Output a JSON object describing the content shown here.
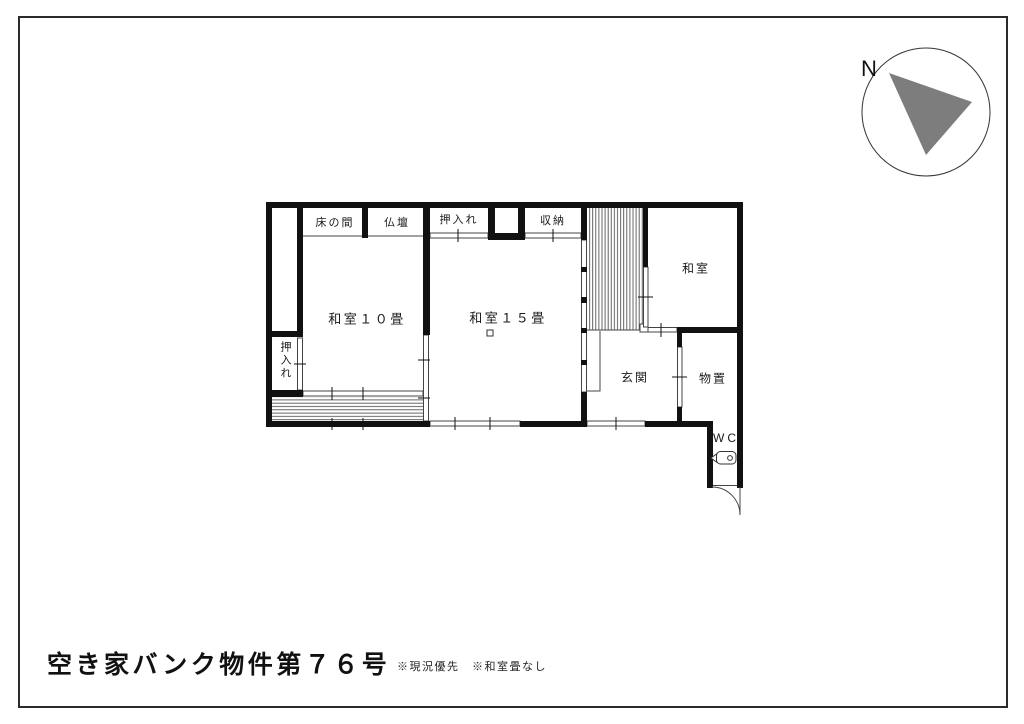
{
  "page": {
    "background": "#ffffff",
    "border_color": "#2b2b2b"
  },
  "title_block": {
    "title": "空き家バンク物件第７６号",
    "note_1": "※現況優先",
    "note_2": "※和室畳なし"
  },
  "compass": {
    "label": "N",
    "needle_color": "#7d7d7d"
  },
  "floor_plan": {
    "wall_color": "#111111",
    "line_color": "#444444",
    "labels": {
      "tokonoma": "床の間",
      "butsudan": "仏壇",
      "oshiire_top": "押入れ",
      "shuno": "収納",
      "washitsu10": "和室１０畳",
      "washitsu15": "和室１５畳",
      "washitsu_ne": "和室",
      "genkan": "玄関",
      "monooki": "物置",
      "wc": "WC",
      "oshiire_left": "押入れ"
    },
    "icons": {
      "toilet": "toilet-icon",
      "north_arrow": "north-arrow-icon",
      "stairs_hatch": "stairs-hatch",
      "veranda_hatch": "veranda-hatch",
      "door_swing": "door-swing-arc"
    }
  }
}
